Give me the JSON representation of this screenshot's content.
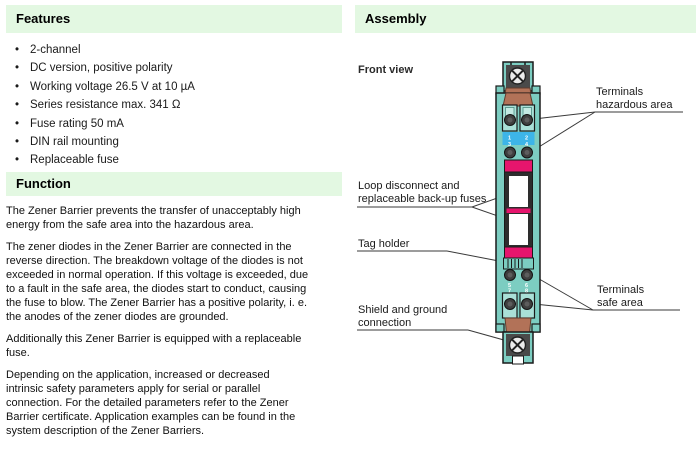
{
  "left": {
    "features": {
      "title": "Features",
      "bullet_char": "•",
      "items": [
        "2-channel",
        "DC version, positive polarity",
        "Working voltage 26.5 V at 10 µA",
        "Series resistance max. 341 Ω",
        "Fuse rating 50 mA",
        "DIN rail mounting",
        "Replaceable fuse"
      ]
    },
    "function": {
      "title": "Function",
      "paragraphs": [
        "The Zener Barrier prevents the transfer of unacceptably high\nenergy from the safe area into the hazardous area.",
        "The zener diodes in the Zener Barrier are connected in the\nreverse direction. The breakdown voltage of the diodes is not\nexceeded in normal operation. If this voltage is exceeded, due\nto a fault in the safe area, the diodes start to conduct, causing\nthe fuse to blow. The Zener Barrier has a positive polarity, i. e.\nthe anodes of the zener diodes are grounded.",
        "Additionally this Zener Barrier is equipped with a replaceable\nfuse.",
        "Depending on the application, increased or decreased\nintrinsic safety parameters apply for serial or parallel\nconnection. For the detailed parameters refer to the Zener\nBarrier certificate. Application examples can be found in the\nsystem description of the Zener Barriers."
      ]
    }
  },
  "right": {
    "assembly_title": "Assembly",
    "front_view_label": "Front view",
    "callouts": {
      "terminals_hazardous": "Terminals\nhazardous area",
      "loop_disconnect": "Loop disconnect and\nreplaceable back-up fuses",
      "tag_holder": "Tag holder",
      "terminals_safe": "Terminals\nsafe area",
      "shield_ground": "Shield and ground\nconnection"
    },
    "device": {
      "terminal_numbers": [
        "1",
        "2",
        "3",
        "4",
        "5",
        "6",
        "7",
        "8"
      ]
    }
  },
  "colors": {
    "header_bar_green": "#e3f8e2",
    "device_teal": "#7ccdc1",
    "device_teal_light": "#a9e0d7",
    "fuse_pink": "#e6156d",
    "label_blue": "#3db5e8",
    "clamp_brown": "#b27258",
    "housing_dark": "#2d2d2d"
  }
}
